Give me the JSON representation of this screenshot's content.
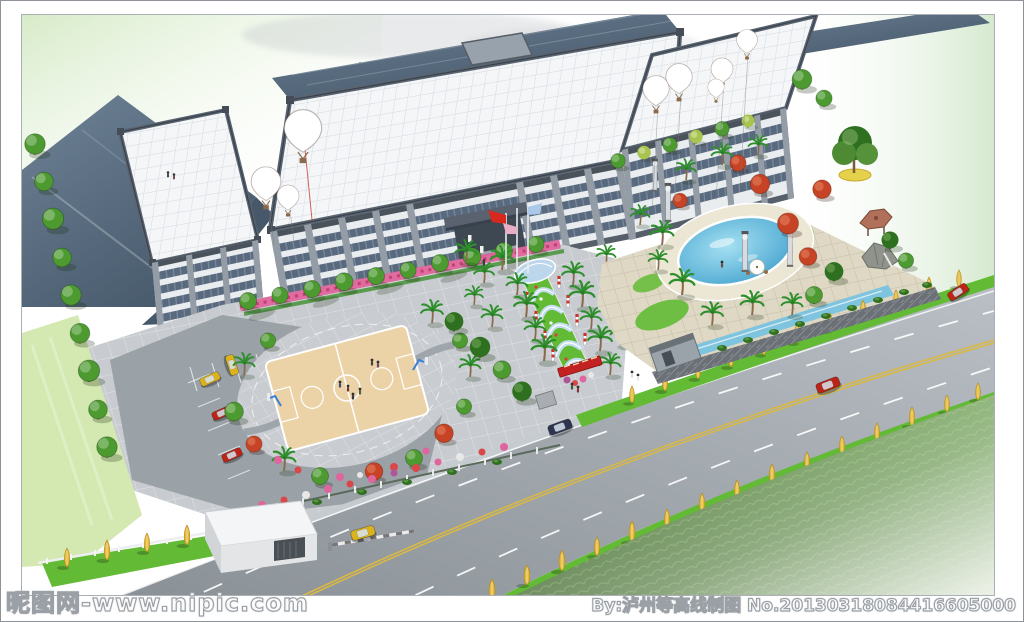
{
  "watermarks": {
    "left": "昵图网-www.nipic.com",
    "right": "By:泸州等高线制图 No.20130318084416605000"
  },
  "scene": {
    "labels": {
      "sky": "sky",
      "complex": "aerial rendering of factory office complex with landscaped grounds",
      "main_building": "main office building with white grid roof",
      "warehouse": "slate roof warehouse block",
      "right_wing": "right wing building",
      "balloons": "rainbow hot-air balloons over roof",
      "flags": "entrance flag poles",
      "walkway": "entrance walkway with glass canopies",
      "court": "circular basketball court plaza",
      "pool": "oval garden swimming pool",
      "pavilion": "garden pavilion and rockery",
      "parking": "parking lot with stalls",
      "gatehouse": "white gatehouse with boom barrier",
      "road": "four-lane road with median markings",
      "grass_field": "dark grass field with mist",
      "gold_trees": "golden street trees on verges"
    }
  },
  "palette": {
    "sky_green": "#dcedcf",
    "slate_roof": "#64788c",
    "slate_roof_dark": "#47586a",
    "white_roof": "#f4f6f8",
    "roof_grid_line": "#d3dae1",
    "parapet": "#525c66",
    "facade_light": "#e9edf0",
    "facade_window": "#5a6a7e",
    "facade_pilaster": "#949ca6",
    "asphalt": "#9aa1a7",
    "plaza": "#c8ccd0",
    "paving_beige": "#ded8c5",
    "lane_yellow": "#d9b844",
    "grass_bright": "#63bb35",
    "grass_dark": "#2f6319",
    "lawn_pale": "#d4e8b2",
    "tree_green": "#4d9a30",
    "tree_dark": "#2f7020",
    "palm_green": "#2f8f2d",
    "gold_tree": "#e2b93c",
    "red_maple": "#c64326",
    "flower_pink": "#e0659c",
    "pool_blue": "#59b7dc",
    "water_channel": "#7fc4de",
    "balloon_red": "#d94f43",
    "balloon_yellow": "#eace5a",
    "balloon_green": "#6aaa52",
    "balloon_pink": "#eaa3ad",
    "flag_red": "#d8281e",
    "flag_pink": "#e9aec6",
    "flag_blue": "#aac9e8",
    "car_yellow": "#ddb31c",
    "car_red": "#bb2417",
    "car_dark": "#2e3450",
    "banner_red": "#c32222",
    "wall_stone": "#6a7076",
    "frame_border": "#8d9398",
    "watermark_stroke": "#9aa0a6"
  }
}
